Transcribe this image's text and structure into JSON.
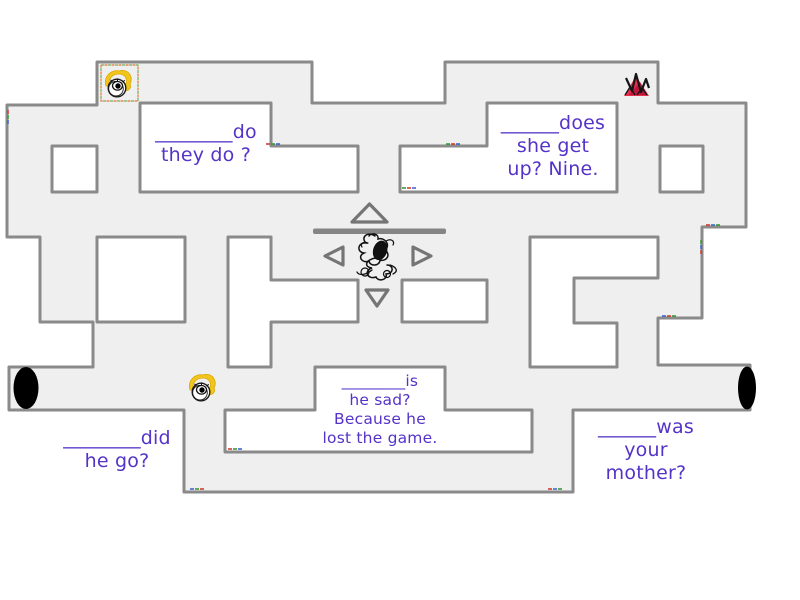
{
  "colors": {
    "corridor": "#efefef",
    "wall": "#8a8a8a",
    "bar": "#858585",
    "text": "#5433c8",
    "token_yellow": "#f2c51d",
    "token_red": "#e62e4d"
  },
  "questions": {
    "q1": {
      "lines": [
        "________do",
        "they do ?"
      ]
    },
    "q2": {
      "lines": [
        "______does",
        "she get",
        "up? Nine."
      ]
    },
    "q3": {
      "lines": [
        "________is",
        "he sad?",
        "Because he",
        "lost the game."
      ]
    },
    "q4": {
      "lines": [
        "________did",
        "he go?"
      ]
    },
    "q5": {
      "lines": [
        "______was",
        "your",
        "mother?"
      ]
    }
  },
  "icons": {
    "dpad_up": "triangle-up",
    "dpad_left": "triangle-left",
    "dpad_right": "triangle-right",
    "dpad_down": "triangle-down",
    "token_top_left": "eye-doodle-yellow",
    "token_top_right": "red-triangle-scribble",
    "token_bottom_left": "eye-doodle-yellow",
    "token_center": "black-scribble-player",
    "tunnel_left": "black-oval-opening",
    "tunnel_right": "black-oval-opening"
  }
}
